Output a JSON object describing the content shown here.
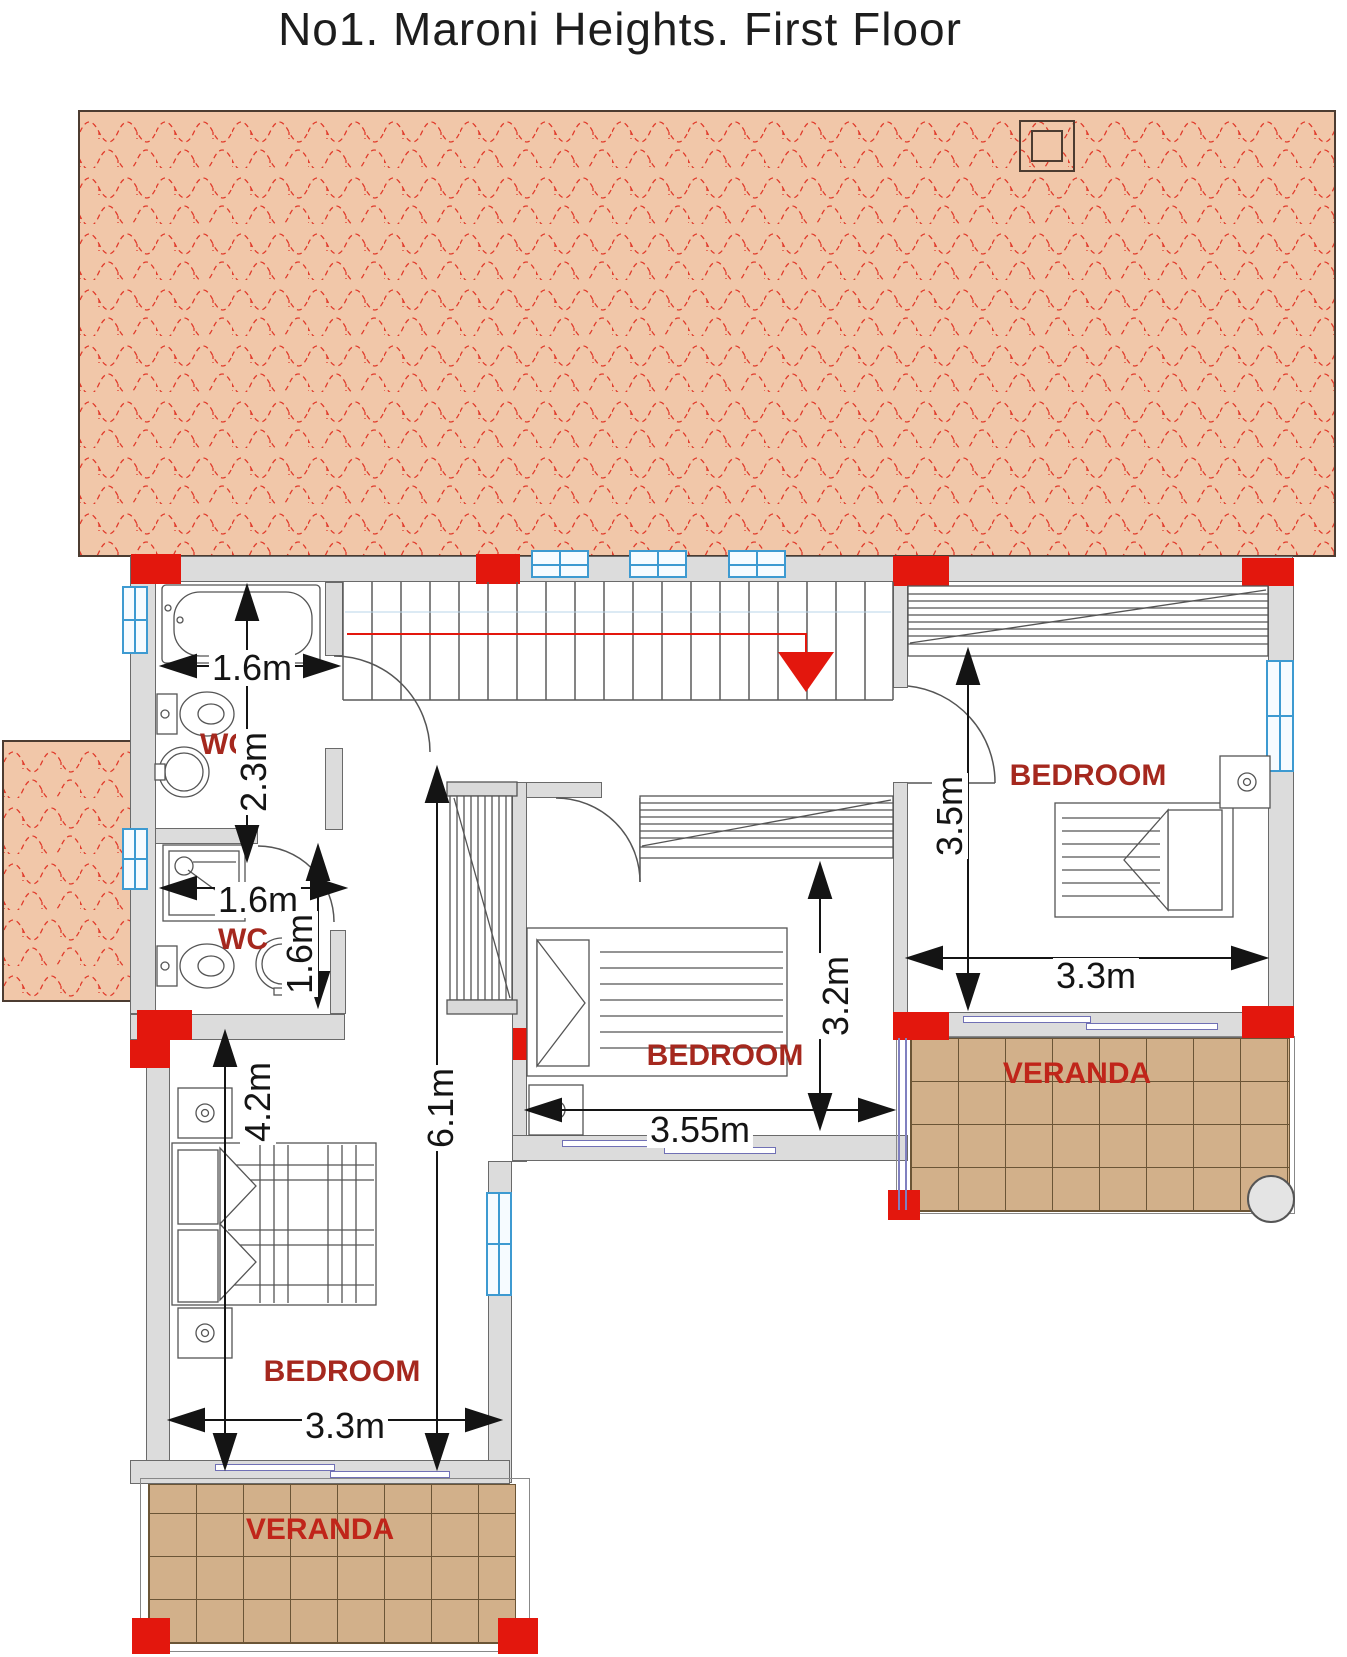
{
  "title": "No1. Maroni Heights. First Floor",
  "rooms": {
    "wc1": {
      "label": "WC"
    },
    "wc2": {
      "label": "WC"
    },
    "bedroom_left": {
      "label": "BEDROOM"
    },
    "bedroom_middle": {
      "label": "BEDROOM"
    },
    "bedroom_right": {
      "label": "BEDROOM"
    },
    "veranda_right": {
      "label": "VERANDA"
    },
    "veranda_bottom": {
      "label": "VERANDA"
    }
  },
  "dimensions": {
    "wc1_width": "1.6m",
    "wc1_height": "2.3m",
    "wc2_width": "1.6m",
    "wc2_height": "1.6m",
    "bedroom_left_height": "4.2m",
    "hall_height": "6.1m",
    "bedroom_left_width": "3.3m",
    "bedroom_middle_width": "3.55m",
    "bedroom_middle_height": "3.2m",
    "bedroom_right_height": "3.5m",
    "bedroom_right_width": "3.3m"
  },
  "colors": {
    "roof_fill": "#f1c7a9",
    "roof_tile_line": "#e03b2b",
    "wall_fill": "#dcdcdc",
    "column_red": "#e3170d",
    "window_blue": "#3d9ad1",
    "room_label_red": "#a5281e",
    "veranda_tile": "#d2b08a"
  }
}
